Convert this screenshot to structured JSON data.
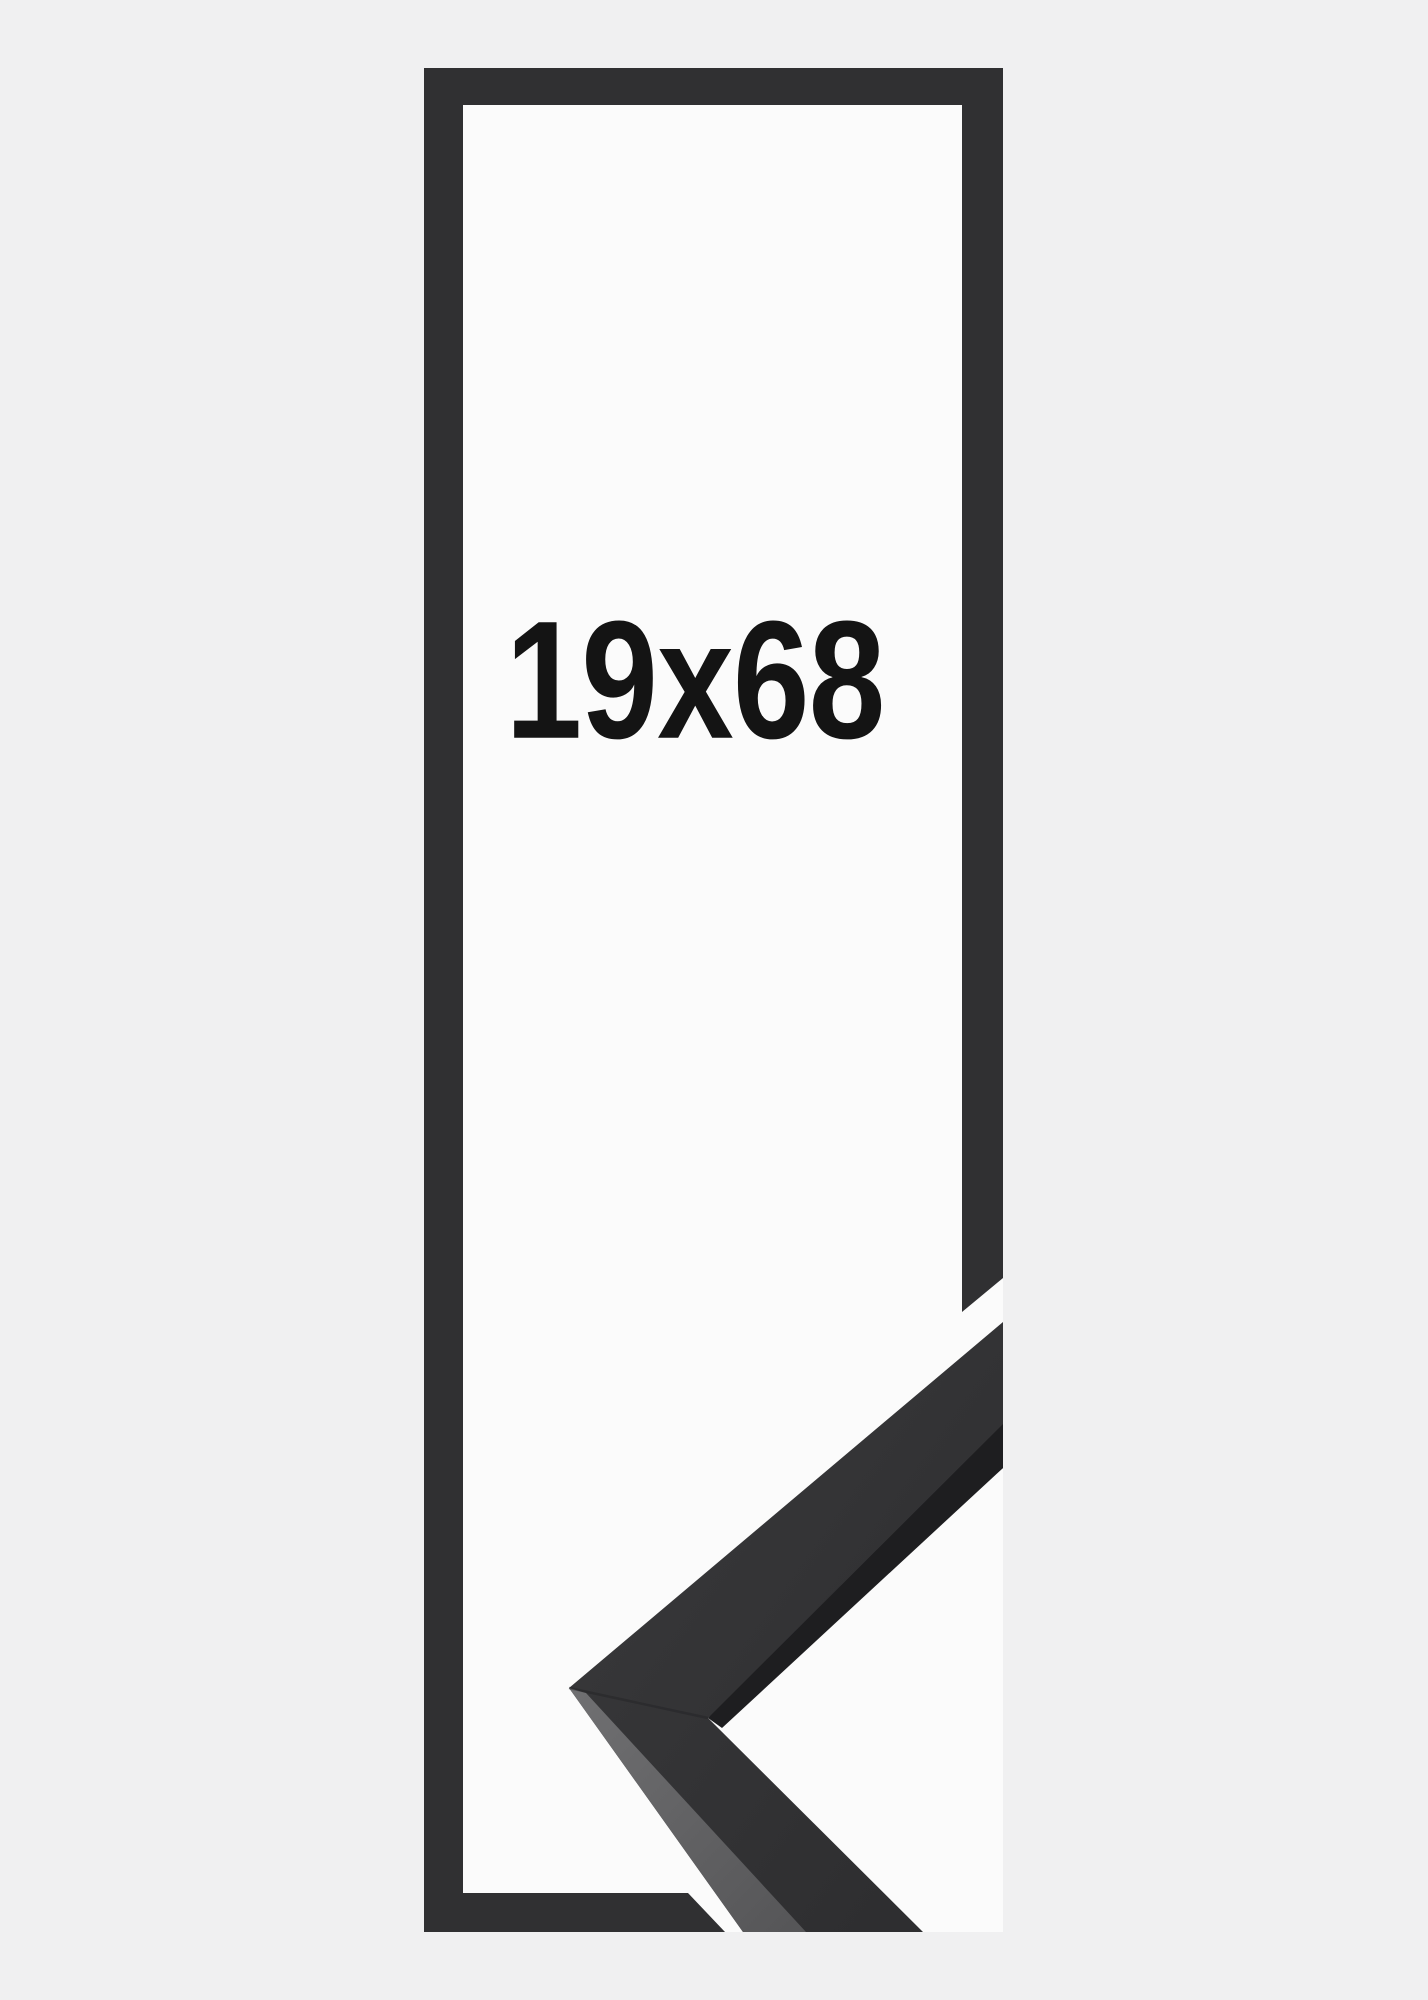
{
  "product_image": {
    "size_label": "19x68",
    "description_names": {
      "subject": "picture-frame-product-shot",
      "frame_outline": "tall-narrow-black-frame-outline",
      "corner_sample": "black-frame-moulding-corner-profile"
    }
  },
  "colors": {
    "bg": "#f0f0f1",
    "opening": "#fbfbfb",
    "frame": "#303032",
    "moulding_front_light": "#3a3a3c",
    "moulding_front_dark": "#2c2c2e",
    "moulding_side_light": "#707072",
    "moulding_side_dark": "#555557",
    "moulding_shadow": "#1e1e20",
    "text": "#141414"
  }
}
